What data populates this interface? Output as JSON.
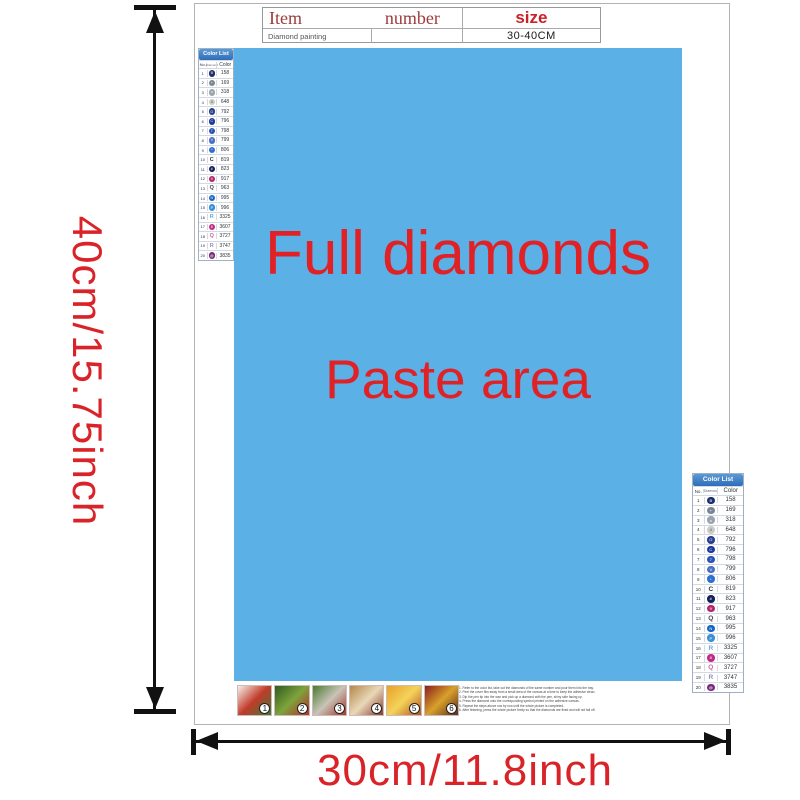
{
  "colors": {
    "accent_red": "#d92328",
    "dark_red": "#9e3a3a",
    "paste_area_blue": "#5bb0e6",
    "paste_text_red": "#e02227",
    "color_list_header_blue": "#3b7ec0"
  },
  "dimensions": {
    "height_label": "40cm/15.75inch",
    "width_label": "30cm/11.8inch"
  },
  "item_table": {
    "header": {
      "item": "Item",
      "number": "number",
      "size": "size"
    },
    "row": {
      "name": "Diamond painting",
      "number": "",
      "size": "30-40CM"
    }
  },
  "paste_area": {
    "line1": "Full diamonds",
    "line2": "Paste area"
  },
  "color_list": {
    "title": "Color List",
    "columns": [
      "No.",
      "Diamond",
      "Color"
    ],
    "rows": [
      {
        "no": "1",
        "code": "158",
        "symbol": "circle",
        "bg": "#1b2f6e",
        "glyph": "B",
        "fg": "#ffffff"
      },
      {
        "no": "2",
        "code": "169",
        "symbol": "circle",
        "bg": "#7b8794",
        "glyph": "+",
        "fg": "#ffffff"
      },
      {
        "no": "3",
        "code": "318",
        "symbol": "circle",
        "bg": "#9aa4ad",
        "glyph": "o",
        "fg": "#ffffff"
      },
      {
        "no": "4",
        "code": "648",
        "symbol": "circle",
        "bg": "#c9cdc6",
        "glyph": "4",
        "fg": "#555555"
      },
      {
        "no": "5",
        "code": "792",
        "symbol": "circle",
        "bg": "#2b3f8e",
        "glyph": "O",
        "fg": "#ffffff"
      },
      {
        "no": "6",
        "code": "796",
        "symbol": "circle",
        "bg": "#1f3a9e",
        "glyph": "C",
        "fg": "#ffffff"
      },
      {
        "no": "7",
        "code": "798",
        "symbol": "circle",
        "bg": "#2b52b5",
        "glyph": "7",
        "fg": "#ffffff"
      },
      {
        "no": "8",
        "code": "799",
        "symbol": "circle",
        "bg": "#4a6fc4",
        "glyph": "V",
        "fg": "#ffffff"
      },
      {
        "no": "9",
        "code": "806",
        "symbol": "circle",
        "bg": "#2e6fd4",
        "glyph": "*",
        "fg": "#ffffff"
      },
      {
        "no": "10",
        "code": "819",
        "symbol": "letter",
        "bg": "",
        "glyph": "C",
        "fg": "#333333"
      },
      {
        "no": "11",
        "code": "823",
        "symbol": "circle",
        "bg": "#14215c",
        "glyph": "#",
        "fg": "#ffffff"
      },
      {
        "no": "12",
        "code": "917",
        "symbol": "circle",
        "bg": "#b5256e",
        "glyph": "9",
        "fg": "#ffffff"
      },
      {
        "no": "13",
        "code": "963",
        "symbol": "letter",
        "bg": "",
        "glyph": "Q",
        "fg": "#444444"
      },
      {
        "no": "14",
        "code": "995",
        "symbol": "circle",
        "bg": "#1565c8",
        "glyph": "N",
        "fg": "#ffffff"
      },
      {
        "no": "15",
        "code": "996",
        "symbol": "circle",
        "bg": "#3b8fd8",
        "glyph": "P",
        "fg": "#ffffff"
      },
      {
        "no": "16",
        "code": "3325",
        "symbol": "letter",
        "bg": "",
        "glyph": "R",
        "fg": "#6fa8d8"
      },
      {
        "no": "17",
        "code": "3607",
        "symbol": "circle",
        "bg": "#c22a8a",
        "glyph": "8",
        "fg": "#ffffff"
      },
      {
        "no": "18",
        "code": "3727",
        "symbol": "letter",
        "bg": "",
        "glyph": "Q",
        "fg": "#c86a9a"
      },
      {
        "no": "19",
        "code": "3747",
        "symbol": "letter",
        "bg": "",
        "glyph": "R",
        "fg": "#8a93b5"
      },
      {
        "no": "20",
        "code": "3835",
        "symbol": "circle",
        "bg": "#7a2a7a",
        "glyph": "@",
        "fg": "#ffffff"
      }
    ]
  },
  "steps": [
    {
      "num": "1",
      "colors": [
        "#f5f2ec",
        "#c23b2a",
        "#3f7a33"
      ]
    },
    {
      "num": "2",
      "colors": [
        "#2e5a1f",
        "#7da33b",
        "#b5302a"
      ]
    },
    {
      "num": "3",
      "colors": [
        "#4a7a2e",
        "#c8c4b8",
        "#a8342a"
      ]
    },
    {
      "num": "4",
      "colors": [
        "#b5874a",
        "#e8d8b8",
        "#8a3a2a"
      ]
    },
    {
      "num": "5",
      "colors": [
        "#e8a12a",
        "#f4d35a",
        "#b5541f"
      ]
    },
    {
      "num": "6",
      "colors": [
        "#8a1f1f",
        "#d8a12a",
        "#5a2a1f"
      ]
    }
  ],
  "instructions": {
    "lines": [
      "1. Refer to the color list, take out the diamonds of the same number and pour them into the tray.",
      "2. Peel the cover film away from a small area of the canvas at a time to keep the adhesive clean.",
      "3. Dip the pen tip into the wax and pick up a diamond with the pen, shiny side facing up.",
      "4. Press the diamond onto the corresponding symbol printed on the adhesive canvas.",
      "5. Repeat the steps above row by row until the whole picture is completed.",
      "6. After finishing, press the whole picture firmly so that the diamonds are fixed and will not fall off."
    ]
  }
}
